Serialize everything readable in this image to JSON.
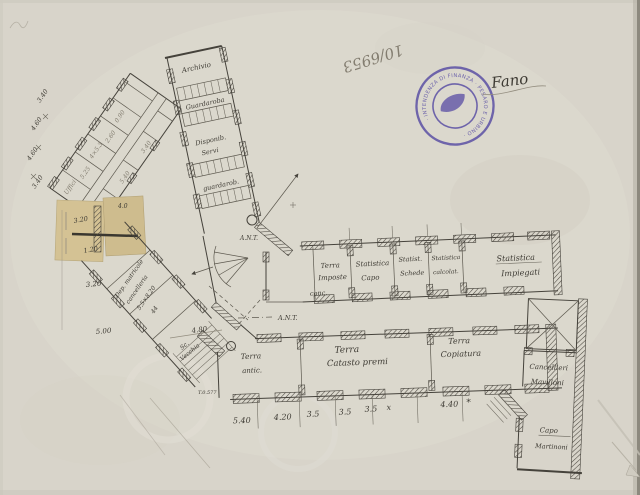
{
  "doc": {
    "file_number": "10/6953",
    "signature": "Fano"
  },
  "stamp": {
    "ring_text": "· INTENDENZA DI FINANZA · PESARO E URBINO ·",
    "color": "#5b50a5"
  },
  "palette": {
    "paper": "#d8d4ca",
    "ink": "#45423b",
    "pencil": "#938d7f",
    "patch": "#d2c094"
  },
  "archive_strip": {
    "r1": "Archivio",
    "r2": "Guardaroba",
    "r3a": "Disponib.",
    "r3b": "Servi",
    "r4": "guardarob."
  },
  "left_wing": {
    "s": [
      "Uffici",
      "5.25",
      "4×5.3",
      "2.60",
      "0.90",
      "2.40",
      "5.40",
      "3.40"
    ],
    "edge": [
      "3.40",
      "4.60",
      "4.60",
      "3.40"
    ]
  },
  "connector": {
    "l1": "Dep. matricole",
    "l2": "cancelleria",
    "l3": "5.5×8.20",
    "l4": "44",
    "stair1": "Sc.",
    "stair2": "Vecchia",
    "dim": "4.80",
    "mark": "T.0.577"
  },
  "patch_dims": [
    "4.0",
    "3.20",
    "1.20",
    "3.20",
    "5.00"
  ],
  "junction": {
    "ant1": "A.N.T.",
    "ant2": "A.N.T."
  },
  "offices": [
    {
      "l1": "Terra",
      "l2": "Imposte",
      "l3": "conc."
    },
    {
      "l1": "Statistica",
      "l2": "Capo"
    },
    {
      "l1": "Statist.",
      "l2": "Schede"
    },
    {
      "l1": "Statistica",
      "l2": "calcolat."
    },
    {
      "l1": "Statistica",
      "l2": "Impiegati"
    }
  ],
  "ground_rooms": [
    {
      "l1": "Terra",
      "l2": "antic."
    },
    {
      "l1": "Terra",
      "l2": "Catasto premi"
    },
    {
      "l1": "Terra",
      "l2": "Copiatura"
    }
  ],
  "right_rooms": [
    {
      "l1": "Cancellieri",
      "l2": "Mavilloni"
    },
    {
      "l1": "Capo",
      "l2": "Martinoni"
    }
  ],
  "dims_bottom": [
    "5.40",
    "4.20",
    "3.5",
    "3.5",
    "3.5",
    "x",
    "4.40",
    "*"
  ]
}
